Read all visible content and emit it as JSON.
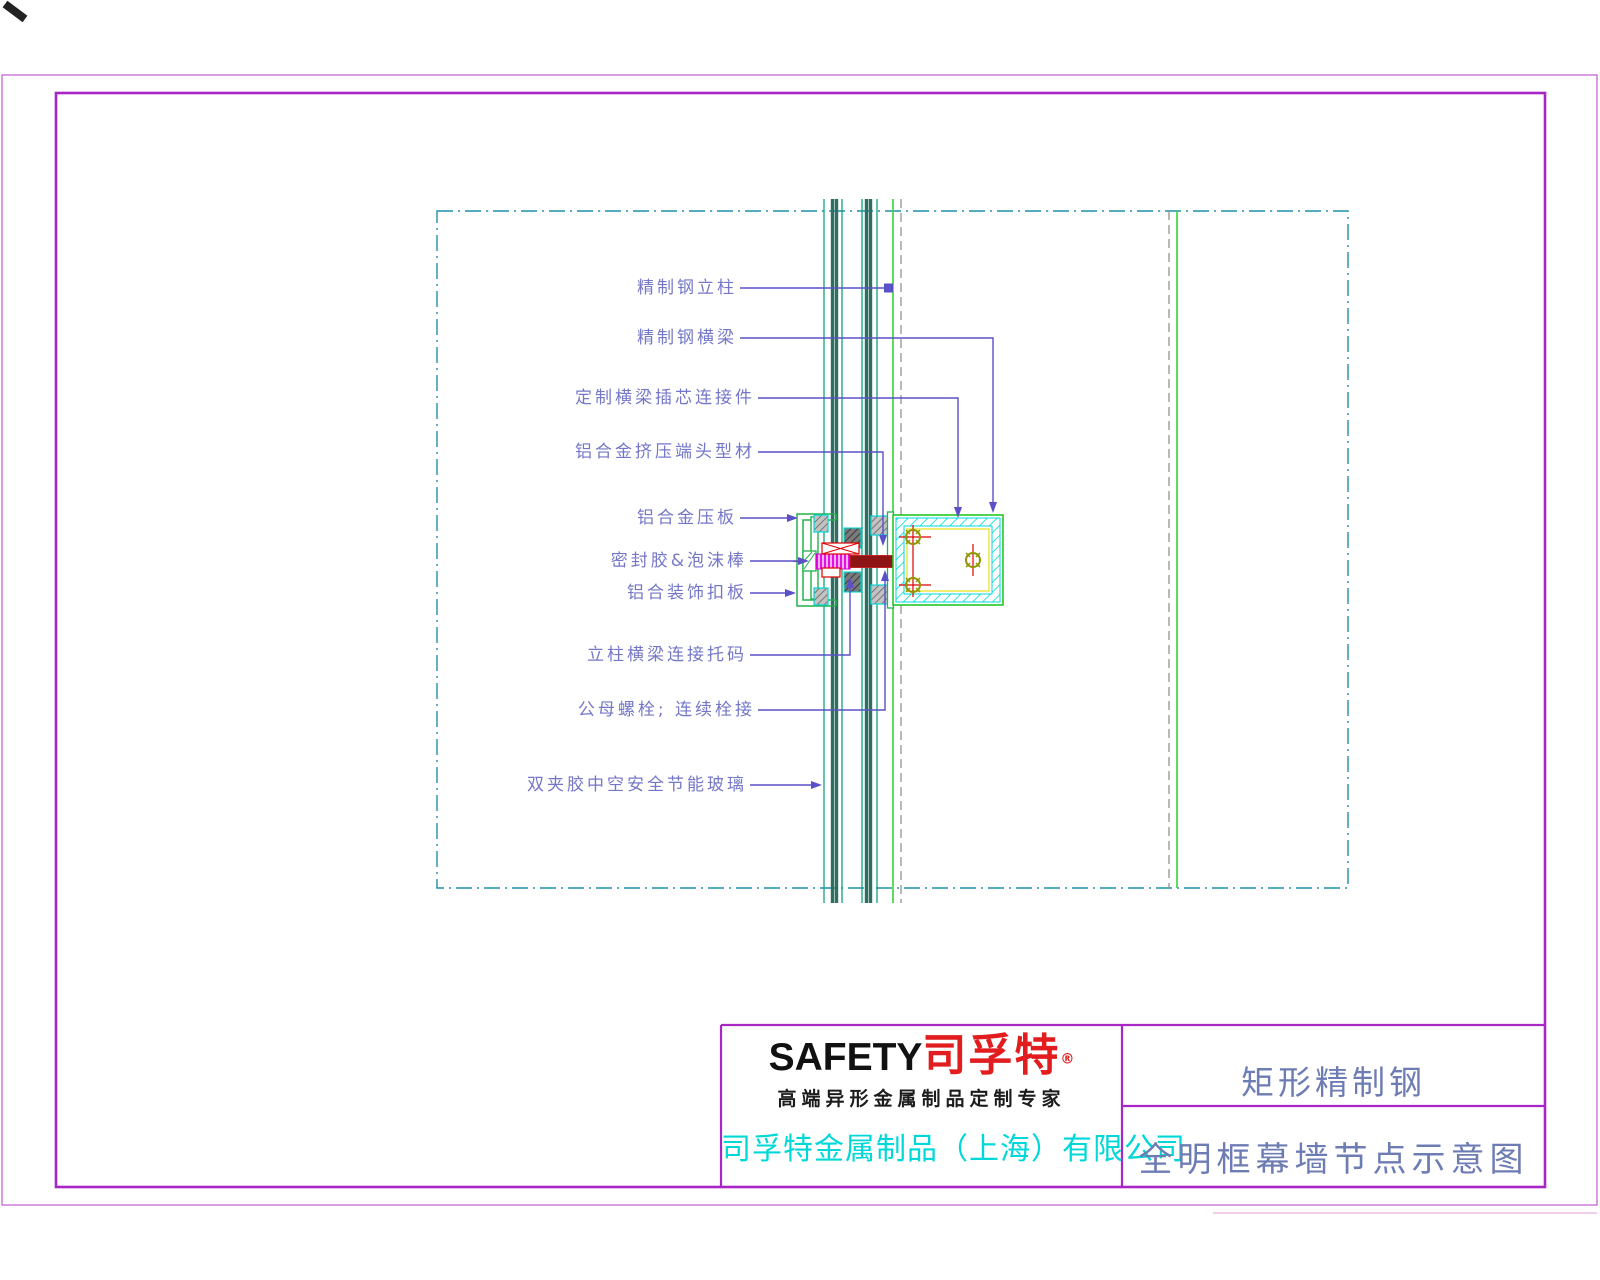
{
  "drawing": {
    "labels": [
      {
        "text": "精制钢立柱"
      },
      {
        "text": "精制钢横梁"
      },
      {
        "text": "定制横梁插芯连接件"
      },
      {
        "text": "铝合金挤压端头型材"
      },
      {
        "text": "铝合金压板"
      },
      {
        "text": "密封胶&泡沫棒"
      },
      {
        "text": "铝合装饰扣板"
      },
      {
        "text": "立柱横梁连接托码"
      },
      {
        "text": "公母螺栓; 连续栓接"
      },
      {
        "text": "双夹胶中空安全节能玻璃"
      }
    ]
  },
  "title_block": {
    "logo": {
      "en": "SAFETY",
      "cn": "司孚特",
      "reg": "®",
      "tagline": "高端异形金属制品定制专家"
    },
    "company": "司孚特金属制品（上海）有限公司",
    "product": "矩形精制钢",
    "drawing_title": "全明框幕墙节点示意图"
  },
  "colors": {
    "border_purple": "#a825c6",
    "leader_purple": "#5a50c8",
    "label_text": "#7477c8",
    "title_text": "#6e7cb4",
    "company_cyan": "#00d8d8",
    "logo_red": "#e21d1f",
    "glass_thin": "#0ea57a",
    "glass_thick": "#2e6f62",
    "bright_green": "#35d435",
    "profile_green": "#21b24a",
    "gasket_cyan": "#00d8d8",
    "inner_yellow": "#efe84e",
    "centerline_red": "#e00000",
    "bolt_maroon": "#8e1515",
    "thread_magenta": "#e000e0",
    "bolt_olive": "#8f9400",
    "hidden_gray": "#8a8a8a",
    "axis_teal": "#1f8fa8"
  }
}
